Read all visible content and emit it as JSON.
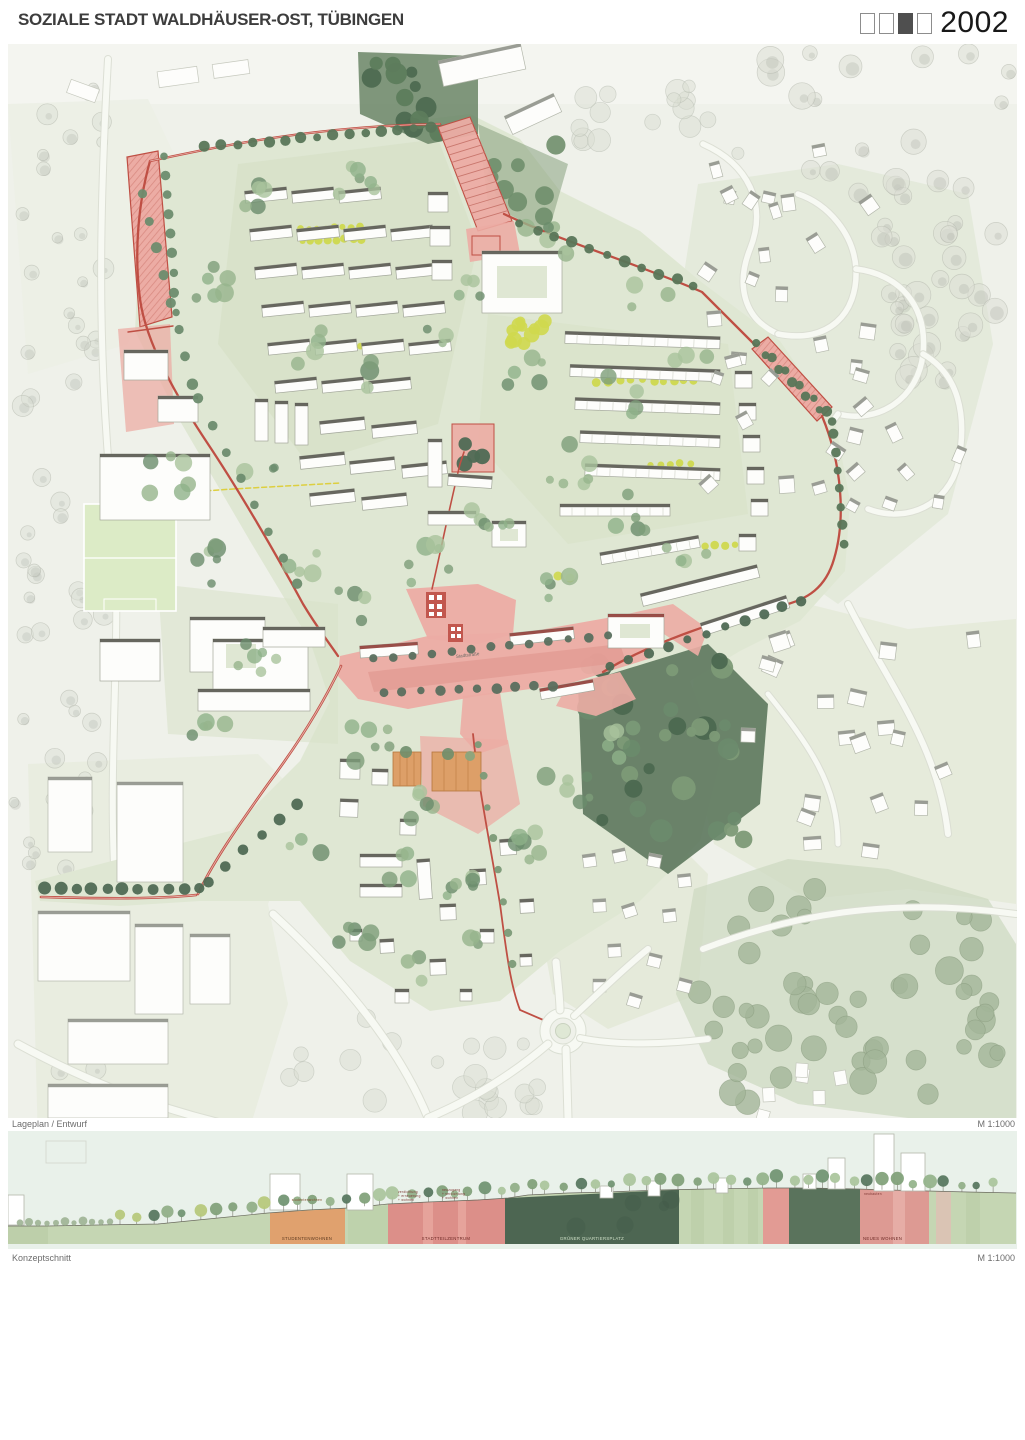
{
  "header": {
    "title": "SOZIALE STADT WALDHÄUSER-OST, TÜBINGEN",
    "year": "2002",
    "phase_boxes": [
      false,
      false,
      true,
      false
    ]
  },
  "map": {
    "caption": "Lageplan / Entwurf",
    "scale": "M 1:1000",
    "street_label": "Stadtstraße"
  },
  "section": {
    "caption": "Konzeptschnitt",
    "scale": "M 1:1000",
    "zones": [
      {
        "id": "studentenwohnen",
        "label": "STUDENTENWOHNEN",
        "note": "studentenwohnen"
      },
      {
        "id": "stadtteilzentrum",
        "label": "STADTTEILZENTRUM",
        "notes": [
          [
            "verdichtung",
            "+ erneuerung",
            "+ wohnen"
          ],
          [
            "neuzugang",
            "+ verdichtung",
            "+ wohnen"
          ]
        ]
      },
      {
        "id": "gruener-quartiersplatz",
        "label": "GRÜNER QUARTIERSPLATZ"
      },
      {
        "id": "neues-wohnen",
        "label": "NEUES WOHNEN",
        "note": "neubauten"
      }
    ]
  },
  "colors": {
    "accent_red": "#bf4f44",
    "plaza_pink": "#ecaca4",
    "deep_pink": "#e29a92",
    "zone_orange": "#dd9f68",
    "quarter_green": "#dfe7d3",
    "forest_green": "#5f7a5f",
    "highlight_yellow": "#cfd84e",
    "section_sky": "#e9f1ea",
    "section_ground": "#c5d6b3",
    "section_dark_green": "#4d6652",
    "section_pink": "#dc8f89",
    "section_orange": "#e0a16e"
  }
}
